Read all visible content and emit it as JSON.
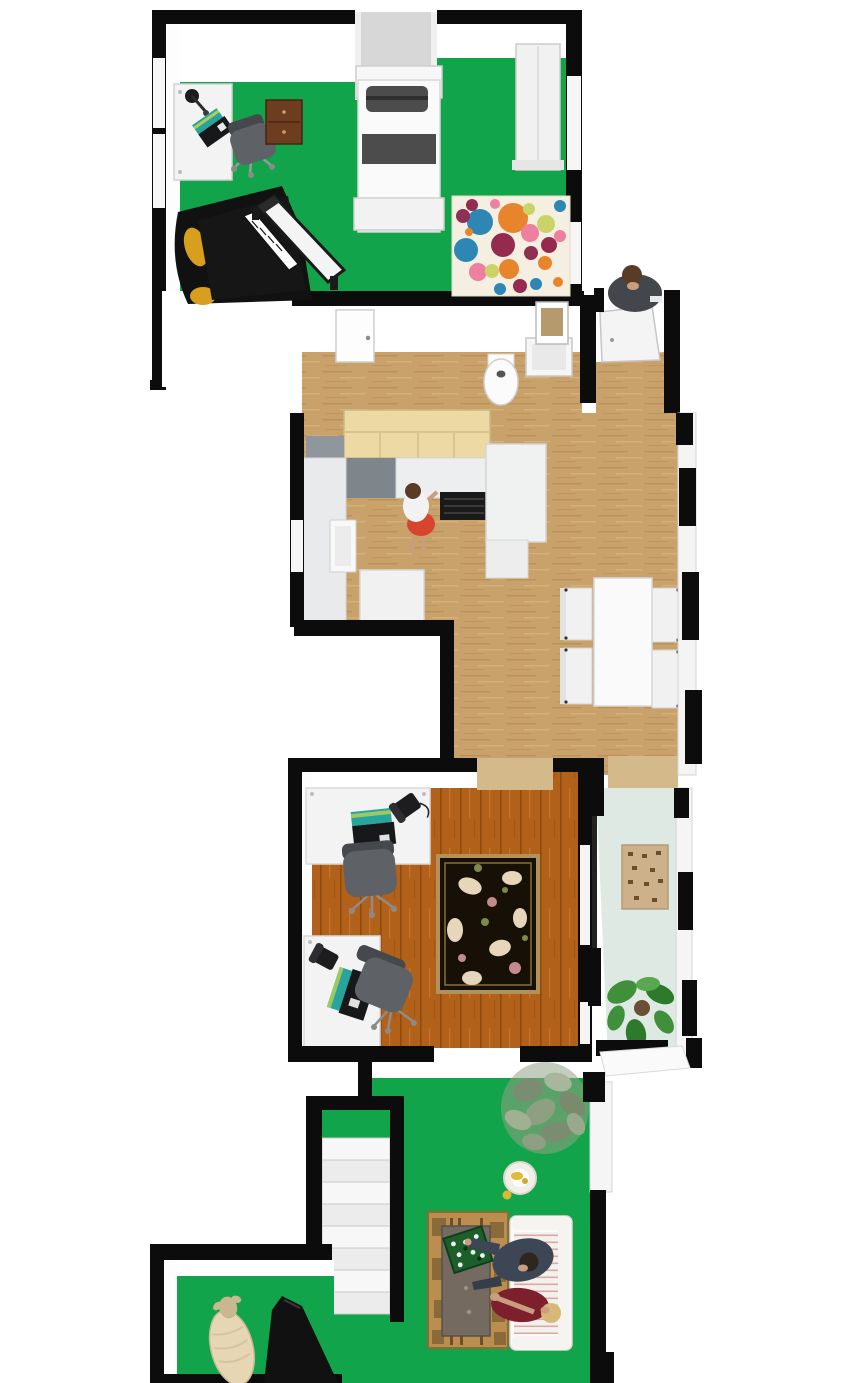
{
  "scene": {
    "type": "floor-plan-3d-top-view",
    "rooms": [
      {
        "id": "bedroom",
        "furniture": [
          "desk",
          "desk-lamp",
          "laptop",
          "office-chair",
          "dresser",
          "single-bed",
          "wardrobe",
          "grand-piano",
          "piano-bench",
          "polka-dot-rug"
        ]
      },
      {
        "id": "bathroom",
        "furniture": [
          "door",
          "bidet",
          "sink",
          "mirror"
        ]
      },
      {
        "id": "entry-hall",
        "furniture": [
          "entry-door"
        ],
        "people": [
          "man-standing"
        ]
      },
      {
        "id": "kitchen-dining",
        "furniture": [
          "upper-cabinets",
          "tall-cabinet",
          "counter",
          "sink",
          "stove",
          "fridge",
          "island",
          "dining-table",
          "dining-chairs"
        ],
        "people": [
          "woman-cook"
        ]
      },
      {
        "id": "office",
        "furniture": [
          "desk-1",
          "laptop-1",
          "phone-1",
          "chair-1",
          "desk-2",
          "laptop-2",
          "phone-2",
          "chair-2",
          "floral-rug"
        ]
      },
      {
        "id": "sunroom",
        "furniture": [
          "patterned-rug",
          "monstera-plant"
        ]
      },
      {
        "id": "living-area",
        "furniture": [
          "staircase",
          "olive-tree",
          "pet-bowl",
          "kilim-mat",
          "coffee-table",
          "game-board",
          "striped-sofa"
        ],
        "people": [
          "man-sitting",
          "woman-sitting"
        ]
      },
      {
        "id": "music-room",
        "furniture": [
          "upright-piano"
        ],
        "animals": [
          "sheep"
        ]
      }
    ]
  },
  "palette": {
    "wall": "#0c0c0c",
    "wall_face": "#ffffff",
    "alcove_gray": "#d7d7d7",
    "floor_green": "#12a44b",
    "wood_kitchen": "#c9a26b",
    "wood_kitchen_streak": "#b78e55",
    "wood_office": "#b2611a",
    "wood_office_streak": "#8f4c0e",
    "wood_threshold": "#d4b98a",
    "floor_mint": "#dfe9e3",
    "cabinet": "#ecd9a4",
    "backsplash": "#7e858b",
    "counter": "#eceef0",
    "stove": "#1a1a1a",
    "appliance": "#f0f1f1",
    "rug_base": "#f5efe1",
    "rug_dots": [
      "#2e86b5",
      "#e8842c",
      "#942a4e",
      "#ee7f9f",
      "#ccd366",
      "#8e3053"
    ],
    "office_rug_base": "#161007",
    "office_rug_border": "#b3925a",
    "rug_bloom_cream": "#e8d6ba",
    "rug_bloom_rose": "#c48a8e",
    "rug_bloom_green": "#7d8a4d",
    "desk": "#f3f3f3",
    "chair_gray": "#5e6266",
    "laptop_teal": "#27a49b",
    "laptop_dark": "#17181a",
    "bed_white": "#f7f7f7",
    "bed_dark": "#4c4c4c",
    "wardrobe": "#f1f1f1",
    "dresser": "#6e3c1e",
    "piano_black": "#111111",
    "piano_gold": "#d89f1e",
    "table_white": "#fafafa",
    "chair_white": "#f1f1f1",
    "sofa": "#f3f1ee",
    "sofa_stripe": "#dca9a0",
    "coffee_table": "#756a60",
    "mat": "#b98e4e",
    "mat_patch": "#8a6a39",
    "game_board": "#1d5f2b",
    "tree_olive": "#94a287",
    "tree_olive_dark": "#798a6d",
    "monstera": "#3f8f3b",
    "monstera_dark": "#2e7a2d",
    "skin": "#c99e7e",
    "hair_brown": "#5a3c26",
    "hair_blonde": "#d8b876",
    "shirt_white": "#f2f2f2",
    "skirt_red": "#d8452f",
    "suit_navy": "#3c4654",
    "dress_maroon": "#7e1f2d",
    "entry_man": "#43474b",
    "sheep": "#e6d6b4",
    "sheep_dark": "#c9b78f",
    "bowl": "#f2efe8",
    "bowl_yellow": "#e2bb35",
    "mirror_tan": "#b3placeholder"
  }
}
